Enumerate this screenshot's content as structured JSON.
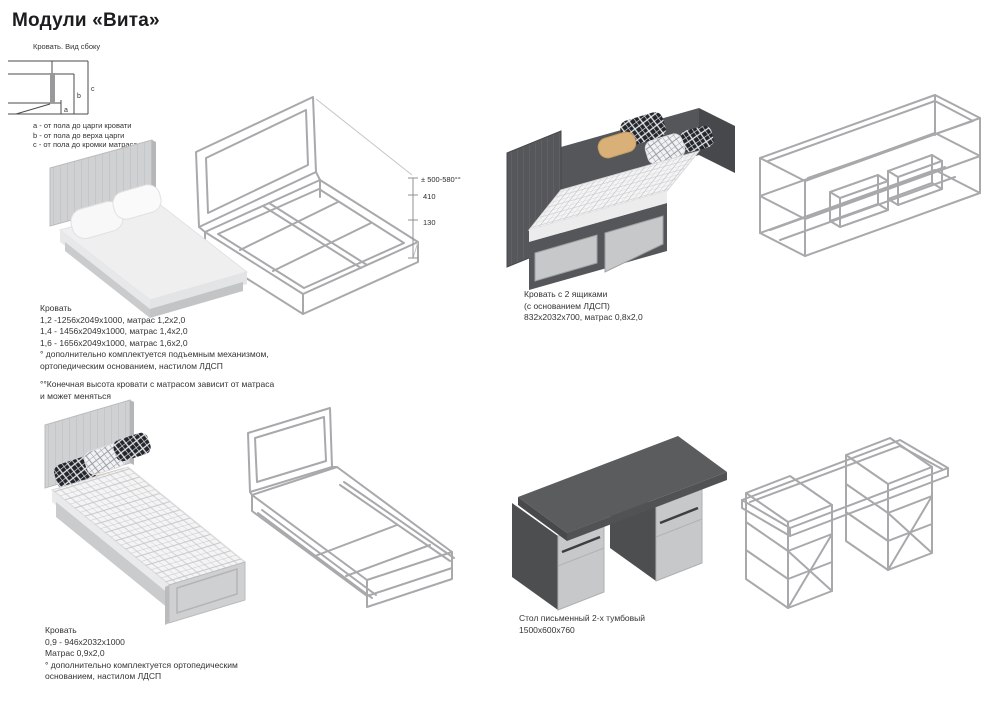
{
  "page": {
    "title": "Модули «Вита»"
  },
  "side_view": {
    "caption": "Кровать. Вид сбоку",
    "dim_labels": {
      "a": "a",
      "b": "b",
      "c": "c"
    },
    "legend": [
      "a - от пола до царги кровати",
      "b - от пола до верха царги",
      "c - от пола до кромки матраса"
    ]
  },
  "wireframe_dims": {
    "total": "± 500-580°°",
    "mid": "410",
    "low": "130"
  },
  "products": {
    "bed_double": {
      "title": "Кровать",
      "sizes": [
        "1,2 -1256х2049х1000, матрас 1,2х2,0",
        "1,4 - 1456х2049х1000, матрас 1,4х2,0",
        "1,6 - 1656х2049х1000, матрас 1,6х2,0"
      ],
      "note1": [
        "° дополнительно комплектуется подъемным механизмом,",
        "ортопедическим основанием, настилом ЛДСП"
      ],
      "note2": [
        "°°Конечная высота кровати с матрасом зависит от матраса",
        "и может меняться"
      ]
    },
    "bed_drawers": {
      "lines": [
        "Кровать с 2 ящиками",
        "(с основанием ЛДСП)",
        "832х2032х700, матрас 0,8х2,0"
      ]
    },
    "bed_single": {
      "lines": [
        "Кровать",
        "0,9 - 946х2032х1000",
        "Матрас 0,9х2,0",
        "° дополнительно комплектуется ортопедическим",
        "основанием, настилом ЛДСП"
      ]
    },
    "desk": {
      "lines": [
        "Стол письменный 2-х тумбовый",
        "1500х600х760"
      ]
    }
  },
  "colors": {
    "dark_gray": "#55575a",
    "light_gray": "#cfd1d3",
    "drawer_front": "#c6c8ca",
    "wireframe": "#a7a9ab",
    "tan_pillow": "#d9b078",
    "text": "#333333"
  }
}
